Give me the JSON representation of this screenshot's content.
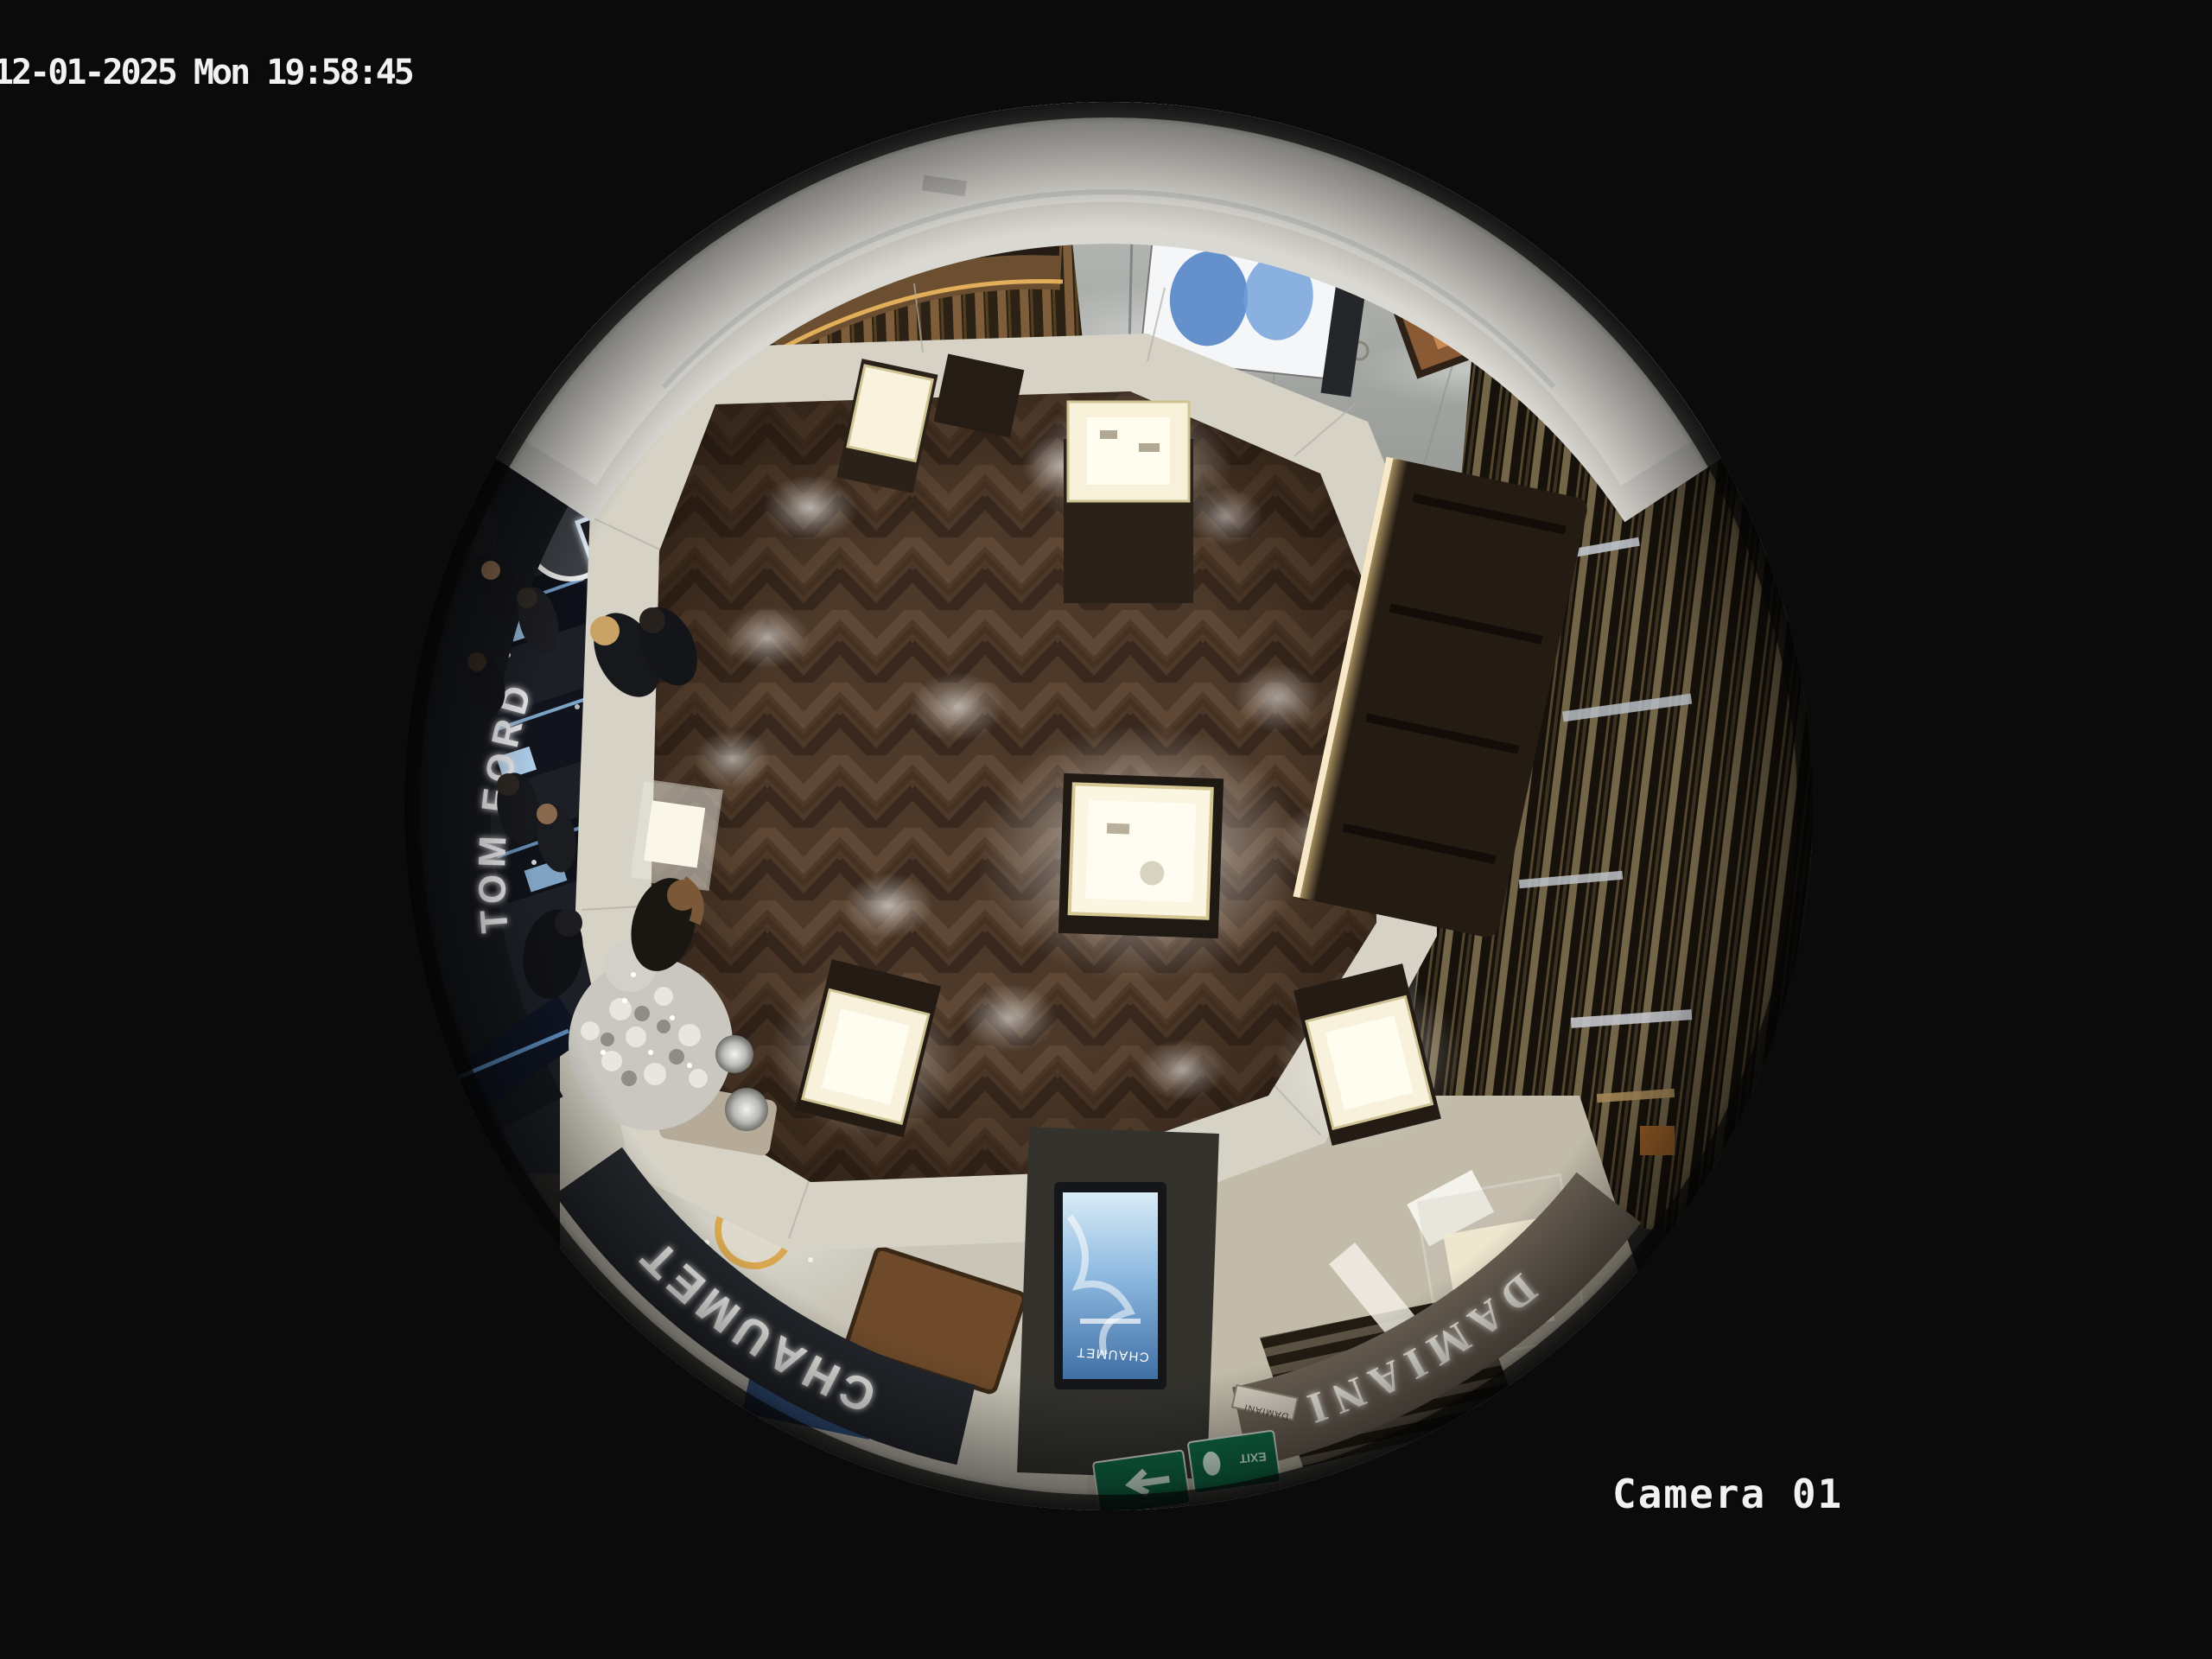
{
  "overlay": {
    "timestamp": "12-01-2025 Mon 19:58:45",
    "camera_label": "Camera 01"
  },
  "scene": {
    "description": "fisheye overhead CCTV view of luxury jewelry boutique floor in mall",
    "signs": {
      "tom_ford": "TOM FORD",
      "chaumet_fascia": "CHAUMET",
      "chaumet_small": "CHAUMET",
      "damiani_fascia": "DAMIANI",
      "damiani_small": "DAMIANI",
      "honor": "HONOR",
      "kiosk_brand": "CHAUMET",
      "exit": "EXIT"
    },
    "colors": {
      "background": "#0b0b0b",
      "overlay_text": "#f2f2f2",
      "wood_floor": "#4d3929",
      "tile_band": "#d6d2c6",
      "marble_corridor": "#a3a6a2",
      "ceiling_arc": "#e9e7e0",
      "chaumet_fascia_bg": "#23262b",
      "damiani_fascia_bg": "#6a6054",
      "kiosk_screen_blue": "#6fa3d3",
      "exit_green": "#0f6b45",
      "case_glow": "#fbf6e2",
      "tom_ford_band": "#15171b"
    }
  }
}
